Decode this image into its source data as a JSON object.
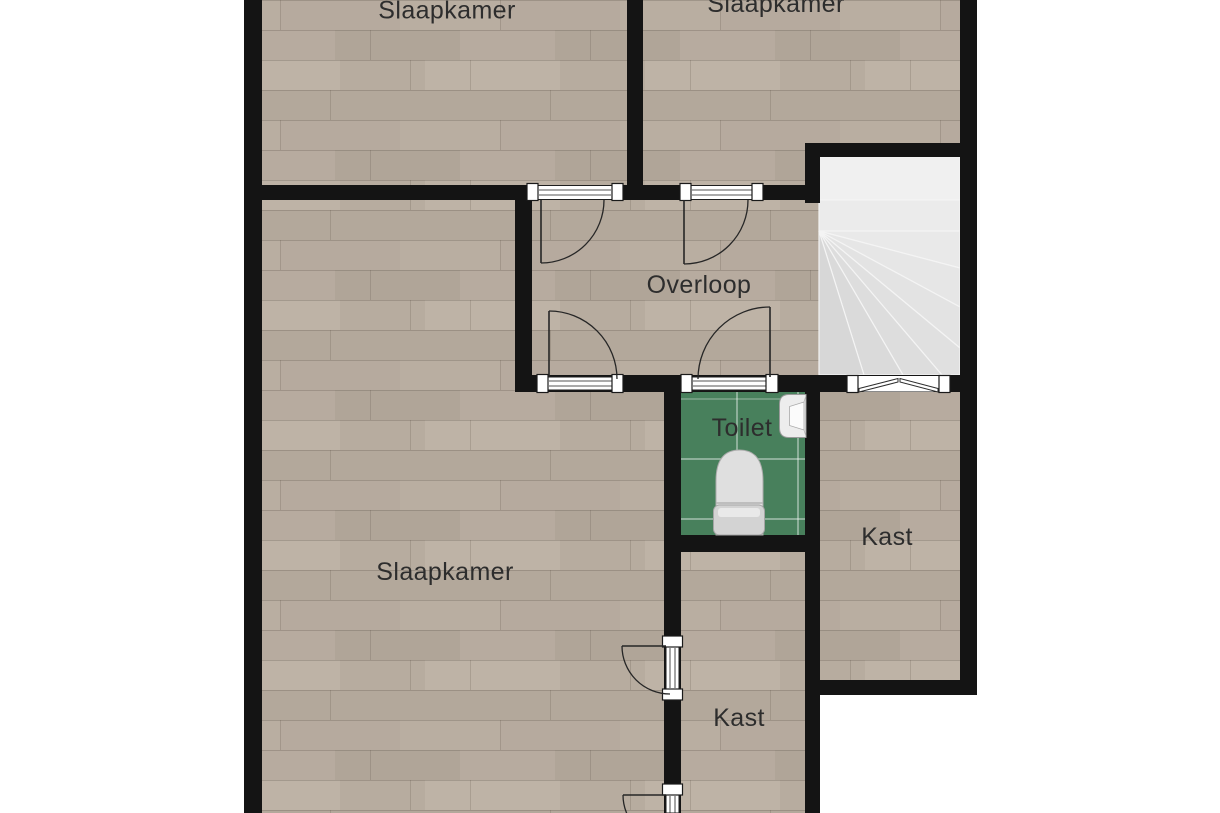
{
  "plan": {
    "kind": "floor-plan-top-view",
    "language": "Dutch",
    "rooms": [
      {
        "id": "slaapkamer-top-left",
        "label": "Slaapkamer"
      },
      {
        "id": "slaapkamer-top-right",
        "label": "Slaapkamer"
      },
      {
        "id": "overloop",
        "label": "Overloop"
      },
      {
        "id": "toilet",
        "label": "Toilet"
      },
      {
        "id": "kast-right",
        "label": "Kast"
      },
      {
        "id": "slaapkamer-large",
        "label": "Slaapkamer"
      },
      {
        "id": "kast-bottom",
        "label": "Kast"
      }
    ],
    "fixtures": [
      {
        "id": "toilet-bowl",
        "room": "toilet"
      },
      {
        "id": "hand-basin",
        "room": "toilet"
      }
    ],
    "staircase": {
      "type": "winder",
      "straight_treads": 2,
      "winder_treads": 7,
      "location": "top-right"
    },
    "colors": {
      "background": "#ffffff",
      "wall": "#141414",
      "wood_floor": "#b5aa9d",
      "tile_floor": "#48805c",
      "stairs": "#e9e9e9",
      "label_text": "#2d2d2d"
    }
  }
}
